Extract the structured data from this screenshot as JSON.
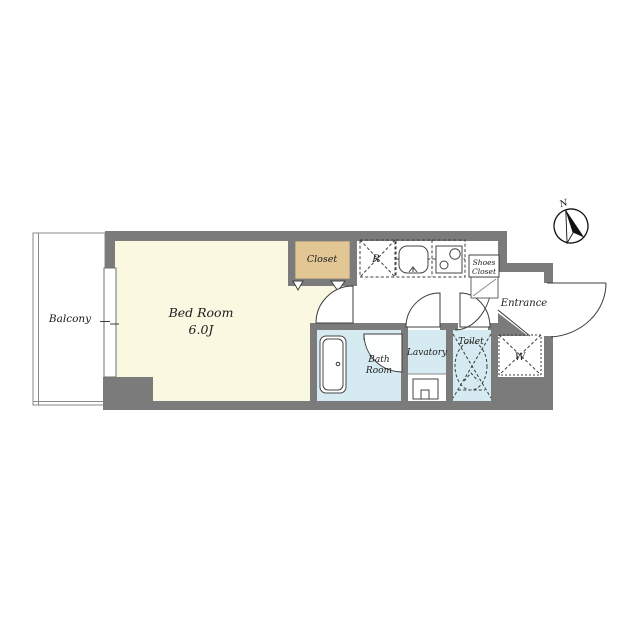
{
  "page": {
    "title": "1K apartment floor plan"
  },
  "colors": {
    "wall": "#7b7b7b",
    "bedroom_floor": "#faf8e1",
    "closet_floor": "#e2c795",
    "wet_floor": "#d5ebf1",
    "line": "#3c3c3c"
  },
  "rooms": {
    "balcony": {
      "label": "Balcony"
    },
    "bedroom": {
      "label": "Bed Room",
      "size": "6.0J"
    },
    "closet": {
      "label": "Closet"
    },
    "refrigerator": {
      "label": "R"
    },
    "shoes_closet": {
      "line1": "Shoes",
      "line2": "Closet"
    },
    "entrance": {
      "label": "Entrance"
    },
    "washer": {
      "label": "W"
    },
    "lavatory": {
      "label": "Lavatory"
    },
    "toilet": {
      "label": "Toilet"
    },
    "bathroom": {
      "line1": "Bath",
      "line2": "Room"
    }
  },
  "compass": {
    "label": "N"
  }
}
